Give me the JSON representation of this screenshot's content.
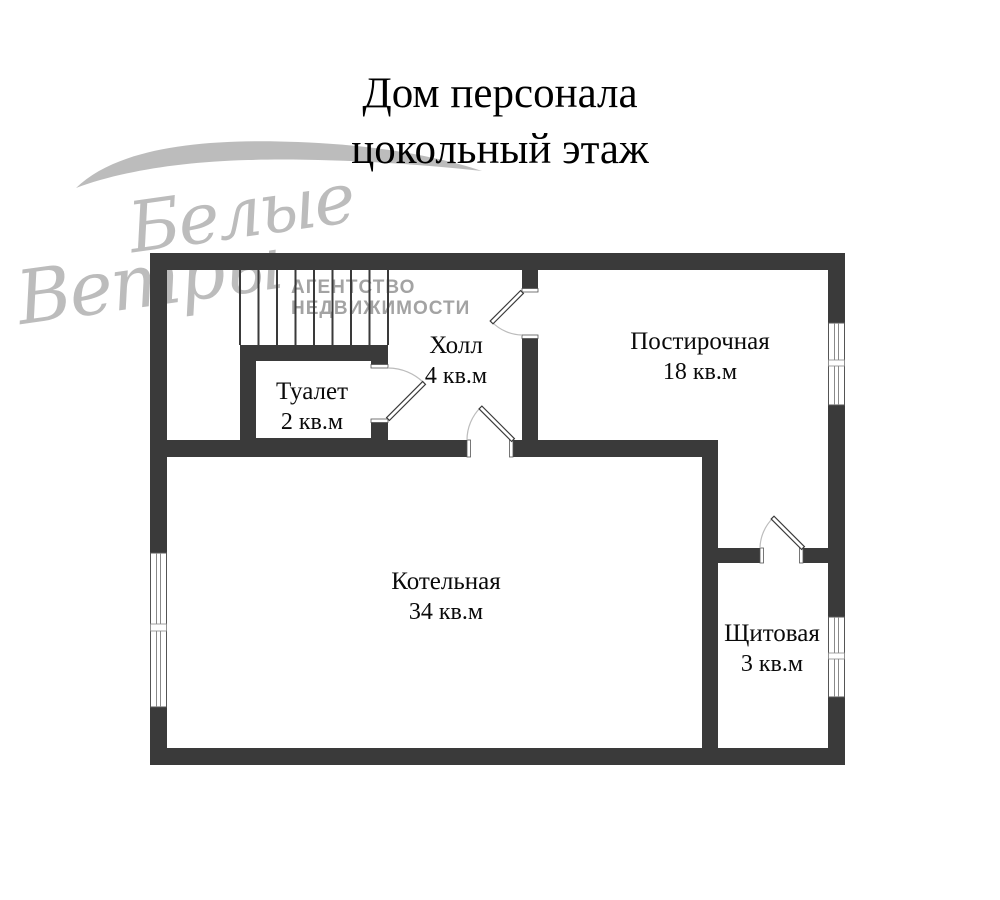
{
  "title": {
    "line1": "Дом персонала",
    "line2": "цокольный этаж"
  },
  "watermark": {
    "brand_word1": "Белые",
    "brand_word2": "Ветры",
    "agency_line1": "АГЕНТСТВО",
    "agency_line2": "НЕДВИЖИМОСТИ"
  },
  "rooms": [
    {
      "name": "Туалет",
      "area": "2 кв.м"
    },
    {
      "name": "Холл",
      "area": "4 кв.м"
    },
    {
      "name": "Постирочная",
      "area": "18 кв.м"
    },
    {
      "name": "Котельная",
      "area": "34 кв.м"
    },
    {
      "name": "Щитовая",
      "area": "3 кв.м"
    }
  ],
  "colors": {
    "wall": "#3a3a3a",
    "watermark_gray": "#b5b5b5",
    "agency_text": "#a3a3a3",
    "door_arc": "#bcbcbc",
    "label_text": "#0a0a0a",
    "background": "#ffffff"
  }
}
